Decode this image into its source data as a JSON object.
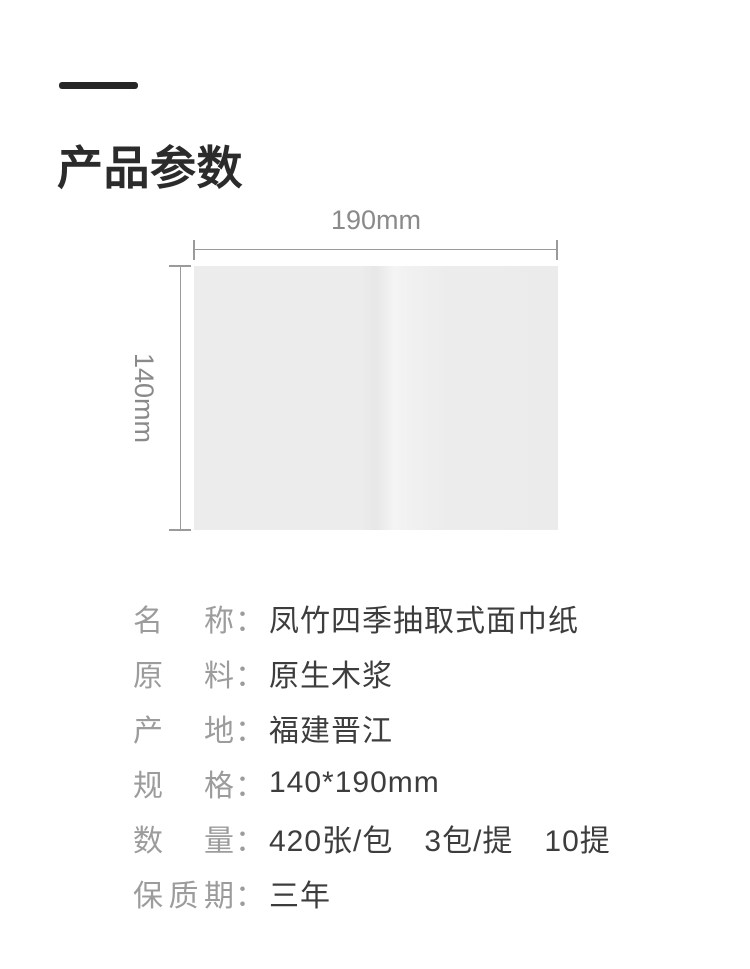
{
  "title": "产品参数",
  "diagram": {
    "width_label": "190mm",
    "height_label": "140mm"
  },
  "specs": {
    "colon": "：",
    "rows": [
      {
        "label": "名称",
        "value": "凤竹四季抽取式面巾纸"
      },
      {
        "label": "原料",
        "value": "原生木浆"
      },
      {
        "label": "产地",
        "value": "福建晋江"
      },
      {
        "label": "规格",
        "value": "140*190mm"
      },
      {
        "label": "数量",
        "value": "420张/包　3包/提　10提"
      },
      {
        "label": "保质期",
        "value": "三年"
      }
    ]
  },
  "colors": {
    "accent_dark": "#262626",
    "dimension_gray": "#9a9a9a",
    "dimension_text_gray": "#8a8a8a",
    "label_gray": "#9c9c9c",
    "value_dark": "#3d3d3d",
    "tissue_fill": "#ececec"
  }
}
